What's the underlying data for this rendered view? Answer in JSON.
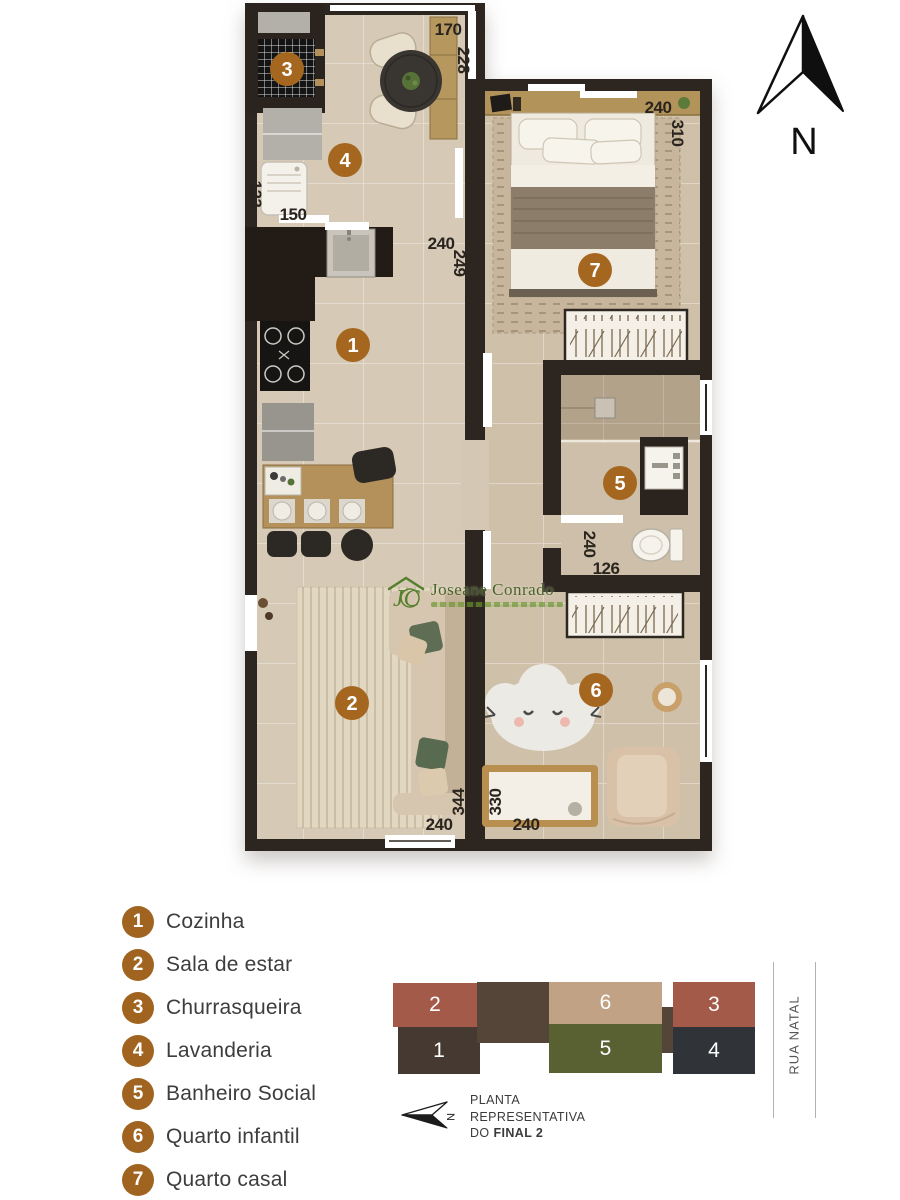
{
  "page": {
    "background": "#ffffff"
  },
  "north": {
    "label": "N"
  },
  "legend": {
    "badge_color": "#a06420",
    "items": [
      {
        "num": "1",
        "label": "Cozinha"
      },
      {
        "num": "2",
        "label": "Sala de estar"
      },
      {
        "num": "3",
        "label": "Churrasqueira"
      },
      {
        "num": "4",
        "label": "Lavanderia"
      },
      {
        "num": "5",
        "label": "Banheiro Social"
      },
      {
        "num": "6",
        "label": "Quarto infantil"
      },
      {
        "num": "7",
        "label": "Quarto casal"
      }
    ]
  },
  "plan": {
    "badge_color": "#a5671f",
    "wall_color": "#2d251f",
    "floor_color": "#d6c9b6",
    "floor_color_bedrooms": "#cfc0aa",
    "dims": {
      "dining_w": "170",
      "dining_d": "228",
      "casal_w": "240",
      "casal_d": "310",
      "lav_d": "123",
      "lav_w": "150",
      "kitchen_w": "240",
      "kitchen_d": "249",
      "bath_d": "240",
      "bath_w": "126",
      "sala_d": "344",
      "sala_w": "240",
      "infantil_d": "330",
      "infantil_w": "240"
    },
    "watermark": {
      "name": "Joseane Conrado",
      "accent_color": "#4c7a23"
    }
  },
  "keyplan": {
    "units": [
      {
        "num": "2",
        "color": "#a45a49"
      },
      {
        "num": "1",
        "color": "#463931"
      },
      {
        "num": "6",
        "color": "#c2a284"
      },
      {
        "num": "5",
        "color": "#596133"
      },
      {
        "num": "3",
        "color": "#a45a49"
      },
      {
        "num": "4",
        "color": "#303439"
      }
    ],
    "caption": {
      "line1": "PLANTA",
      "line2": "REPRESENTATIVA",
      "line3_prefix": "DO",
      "line3_bold": "FINAL 2"
    },
    "street": "RUA NATAL",
    "north_label": "N"
  }
}
